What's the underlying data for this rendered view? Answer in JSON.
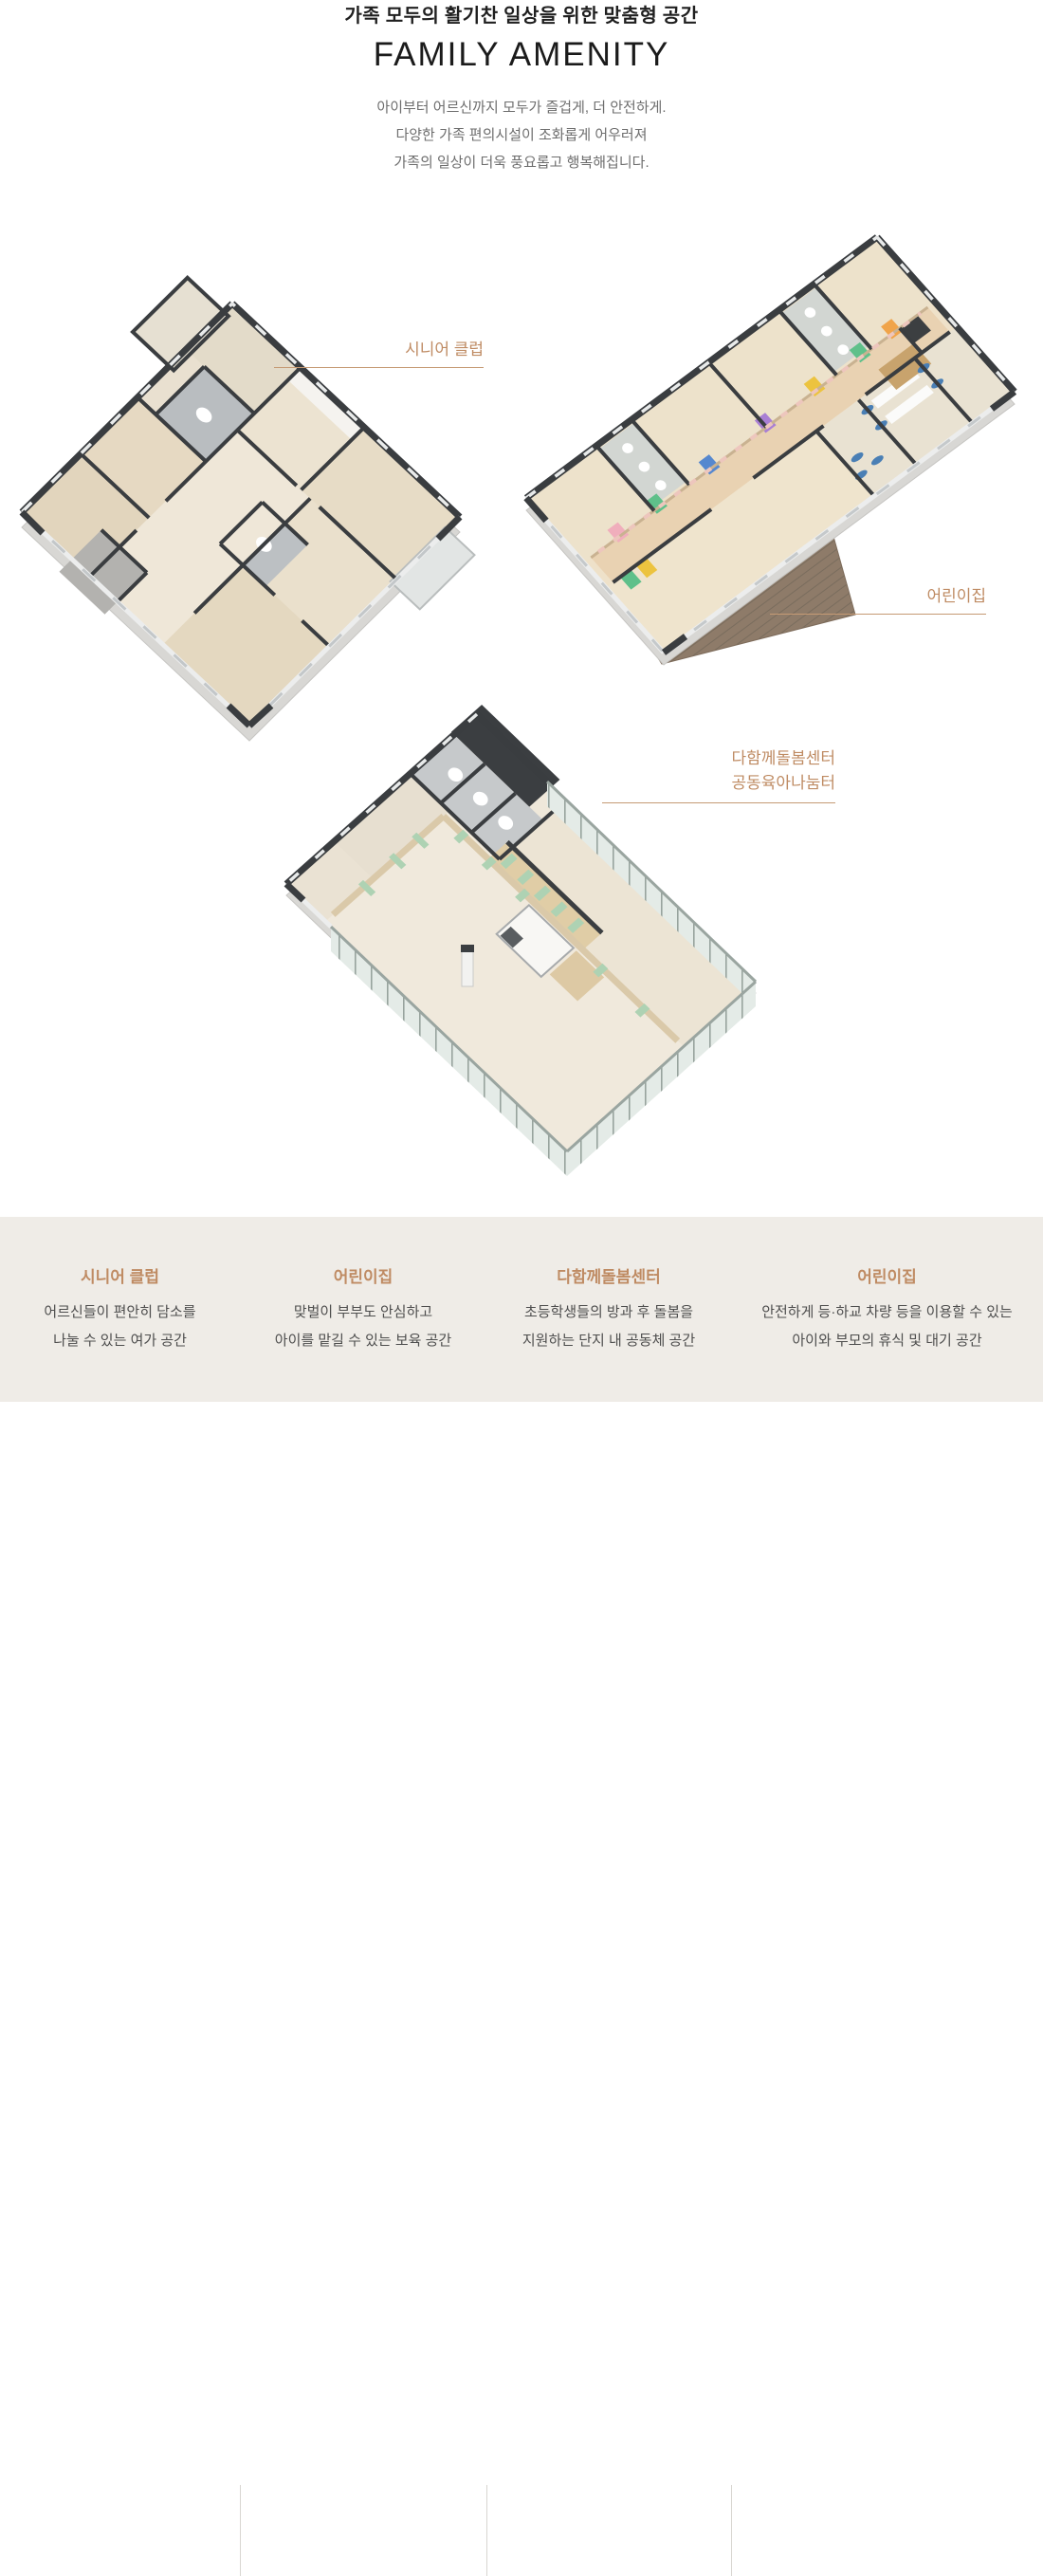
{
  "header": {
    "subtitle_kr": "가족 모두의 활기찬 일상을 위한 맞춤형 공간",
    "title_en": "FAMILY AMENITY",
    "description_lines": [
      "아이부터 어르신까지 모두가 즐겁게, 더 안전하게.",
      "다양한 가족 편의시설이 조화롭게 어우러져",
      "가족의 일상이 더욱 풍요롭고 행복해집니다."
    ]
  },
  "colors": {
    "accent_brown": "#bf8b63",
    "label_line": "#c59a74",
    "footer_background": "#efece7",
    "wall_dark": "#3a3d40",
    "floor_beige": "#ece3d3",
    "glass_green": "#e4ebe7",
    "deck_wood": "#8e7b69",
    "mint_accent": "#b7d6bb"
  },
  "floorplan_labels": {
    "senior_club": {
      "line1": "시니어 클럽"
    },
    "daycare": {
      "line1": "어린이집"
    },
    "care_center": {
      "line1": "다함께돌봄센터",
      "line2": "공동육아나눔터"
    }
  },
  "footer": {
    "items": [
      {
        "title": "시니어 클럽",
        "line1": "어르신들이 편안히 담소를",
        "line2": "나눌 수 있는 여가 공간"
      },
      {
        "title": "어린이집",
        "line1": "맞벌이 부부도 안심하고",
        "line2": "아이를 맡길 수 있는 보육 공간"
      },
      {
        "title": "다함께돌봄센터",
        "line1": "초등학생들의 방과 후 돌봄을",
        "line2": "지원하는 단지 내 공동체 공간"
      },
      {
        "title": "어린이집",
        "line1": "안전하게 등·하교 차량 등을 이용할 수 있는",
        "line2": "아이와 부모의 휴식 및 대기 공간"
      }
    ]
  }
}
